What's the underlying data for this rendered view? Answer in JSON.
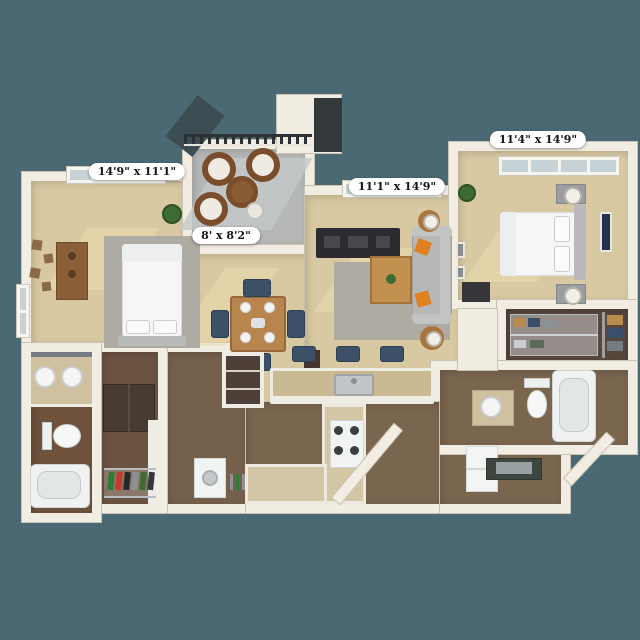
{
  "scene": {
    "type": "3d-apartment-floor-plan",
    "background_color": "#4b6972",
    "wall_color": "#f1ede3",
    "carpet_color": "#d8c9a2",
    "wood_floor_color": "#7a654f",
    "patio_floor_color": "#b6b8b8"
  },
  "dimension_labels": {
    "bedroom1": "14'9\" x 11'1\"",
    "patio": "8' x 8'2\"",
    "living": "11'1\" x 14'9\"",
    "bedroom2": "11'4\" x 14'9\""
  },
  "rooms": [
    {
      "name": "Bedroom 1",
      "dimensions": "14'9\" x 11'1\"",
      "floor": "carpet",
      "furniture": [
        "bed",
        "rug",
        "dresser",
        "wall-art",
        "plant",
        "windows"
      ]
    },
    {
      "name": "Patio",
      "dimensions": "8' x 8'2\"",
      "floor": "concrete",
      "furniture": [
        "railing",
        "3 wicker chairs",
        "round wicker table",
        "side table"
      ]
    },
    {
      "name": "Living Room",
      "dimensions": "11'1\" x 14'9\"",
      "floor": "carpet",
      "furniture": [
        "sofa",
        "orange pillows",
        "coffee table",
        "tv console",
        "rug",
        "side tables with lamps",
        "wall frames",
        "window"
      ]
    },
    {
      "name": "Bedroom 2",
      "dimensions": "11'4\" x 14'9\"",
      "floor": "carpet",
      "furniture": [
        "bed",
        "headboard",
        "2 nightstands with lamps",
        "wall art",
        "plant",
        "bench",
        "window"
      ]
    },
    {
      "name": "Dining Area",
      "floor": "carpet",
      "furniture": [
        "square table",
        "4 navy chairs",
        "place settings",
        "pantry cabinet"
      ]
    },
    {
      "name": "Kitchen",
      "floor": "wood",
      "furniture": [
        "breakfast bar",
        "bar sink",
        "3 navy stools",
        "range with burners",
        "counters",
        "refrigerator"
      ]
    },
    {
      "name": "Entry",
      "floor": "wood",
      "furniture": [
        "console table with mirror"
      ]
    },
    {
      "name": "Bathroom 1",
      "floor": "wood",
      "furniture": [
        "double vanity",
        "2 sinks",
        "mirror",
        "toilet",
        "bathtub"
      ]
    },
    {
      "name": "Bathroom 2",
      "floor": "wood",
      "furniture": [
        "vanity sink",
        "toilet",
        "bathtub"
      ]
    },
    {
      "name": "Walk-in Closet 1",
      "floor": "wood",
      "furniture": [
        "wardrobe",
        "shoe rack",
        "shelving"
      ]
    },
    {
      "name": "Walk-in Closet 2",
      "floor": "wood",
      "furniture": [
        "shelving with folded clothes",
        "hanging rod with clothes"
      ]
    },
    {
      "name": "Laundry / Hall",
      "floor": "wood",
      "furniture": [
        "linen closet",
        "washer",
        "dish rack"
      ]
    }
  ],
  "accent_colors": {
    "sofa_pillow_orange": "#e08020",
    "chair_navy": "#3c5068",
    "wood_furniture": "#b9854e",
    "wicker": "#7a4e2c",
    "railing_dark": "#2b3134"
  }
}
